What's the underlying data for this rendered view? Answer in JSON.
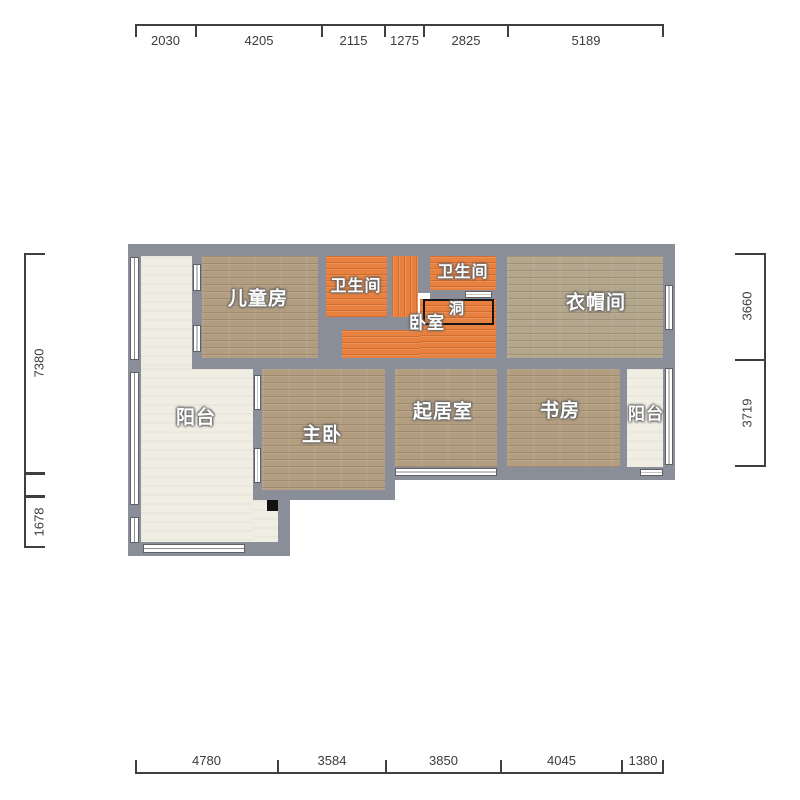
{
  "dims": {
    "top": {
      "d1": "2030",
      "d2": "4205",
      "d3": "2115",
      "d4": "1275",
      "d5": "2825",
      "d6": "5189"
    },
    "bottom": {
      "d1": "4780",
      "d2": "3584",
      "d3": "3850",
      "d4": "4045",
      "d5": "1380"
    },
    "left": {
      "d1": "7380",
      "d2": "1678"
    },
    "right": {
      "d1": "3660",
      "d2": "3719"
    }
  },
  "rooms": {
    "children": {
      "label": "儿童房"
    },
    "bath_left": {
      "label": "卫生间"
    },
    "bath_top": {
      "label": "卫生间"
    },
    "bedroom": {
      "label": "卧室"
    },
    "hole": {
      "label": "洞"
    },
    "cloakroom": {
      "label": "衣帽间"
    },
    "balcony_left": {
      "label": "阳台"
    },
    "master": {
      "label": "主卧"
    },
    "living": {
      "label": "起居室"
    },
    "study": {
      "label": "书房"
    },
    "balcony_right": {
      "label": "阳台"
    }
  },
  "colors": {
    "wall": "#8a8e98",
    "wood_floor": "#b29d80",
    "tile_floor": "#e8813f",
    "balcony_floor": "#f0ede3",
    "dimension_text": "#3b3b3b",
    "label_text": "#ffffff"
  }
}
